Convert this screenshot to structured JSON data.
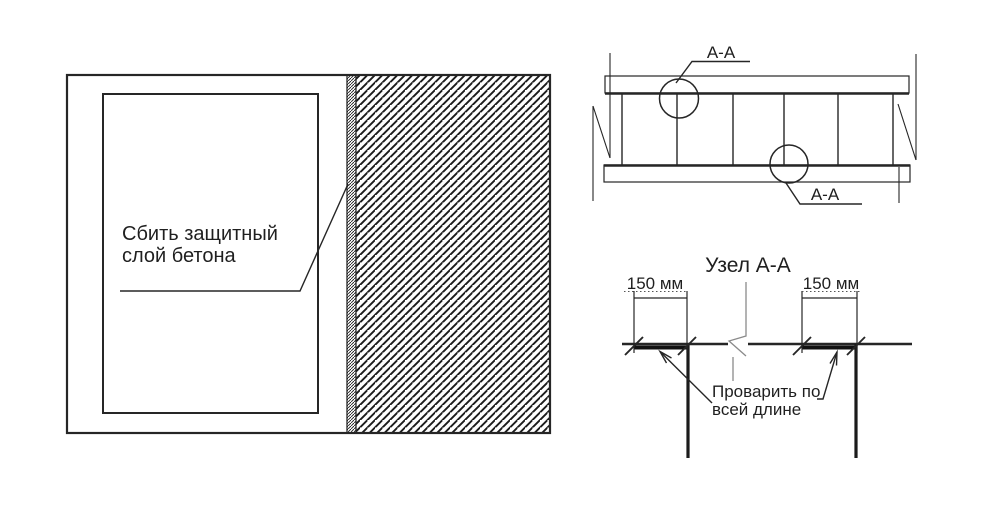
{
  "left_view": {
    "note": {
      "line1": "Сбить защитный",
      "line2": "слой бетона"
    }
  },
  "plan_view": {
    "section_label_top": "А-А",
    "section_label_bottom": "А-А"
  },
  "detail_view": {
    "title": "Узел А-А",
    "dim_left": "150 мм",
    "dim_right": "150 мм",
    "weld_note": {
      "line1": "Проварить по",
      "line2": "всей длине"
    }
  },
  "colors": {
    "line": "#262626",
    "centerline": "#8a8a8a",
    "background": "#ffffff"
  }
}
